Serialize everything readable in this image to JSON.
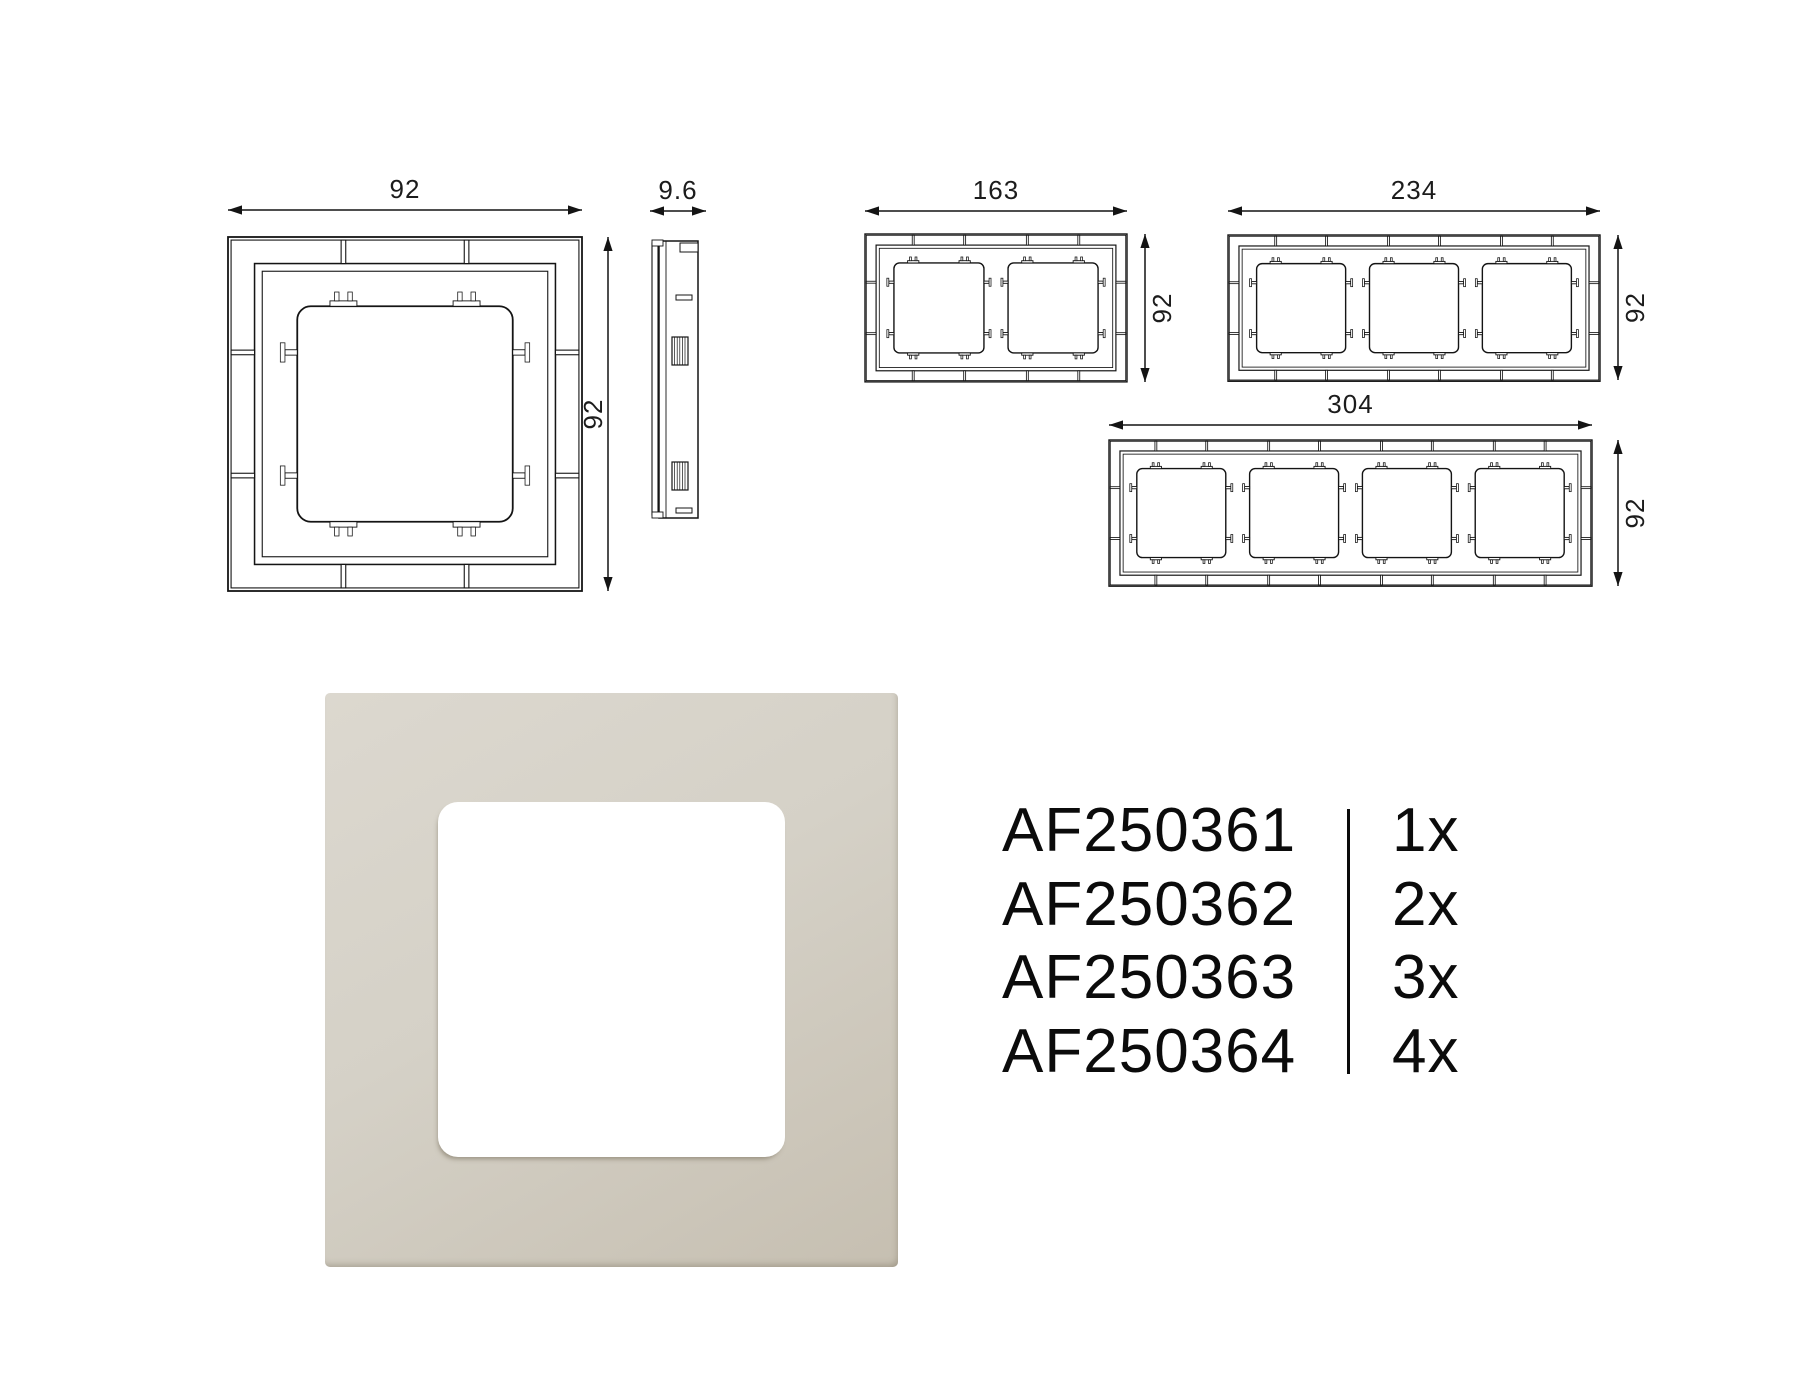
{
  "drawings": {
    "single_front": {
      "width_label": "92",
      "height_label": "92"
    },
    "side_profile": {
      "depth_label": "9.6"
    },
    "gang2": {
      "width_label": "163",
      "height_label": "92"
    },
    "gang3": {
      "width_label": "234",
      "height_label": "92"
    },
    "gang4": {
      "width_label": "304",
      "height_label": "92"
    }
  },
  "photo": {
    "frame_color_light": "#dcd8cf",
    "frame_color_mid": "#d5d1c7",
    "frame_color_dark": "#c6bfb1",
    "cutout_color": "#ffffff"
  },
  "product_table": {
    "rows": [
      {
        "code": "AF250361",
        "qty": "1x"
      },
      {
        "code": "AF250362",
        "qty": "2x"
      },
      {
        "code": "AF250363",
        "qty": "3x"
      },
      {
        "code": "AF250364",
        "qty": "4x"
      }
    ]
  }
}
